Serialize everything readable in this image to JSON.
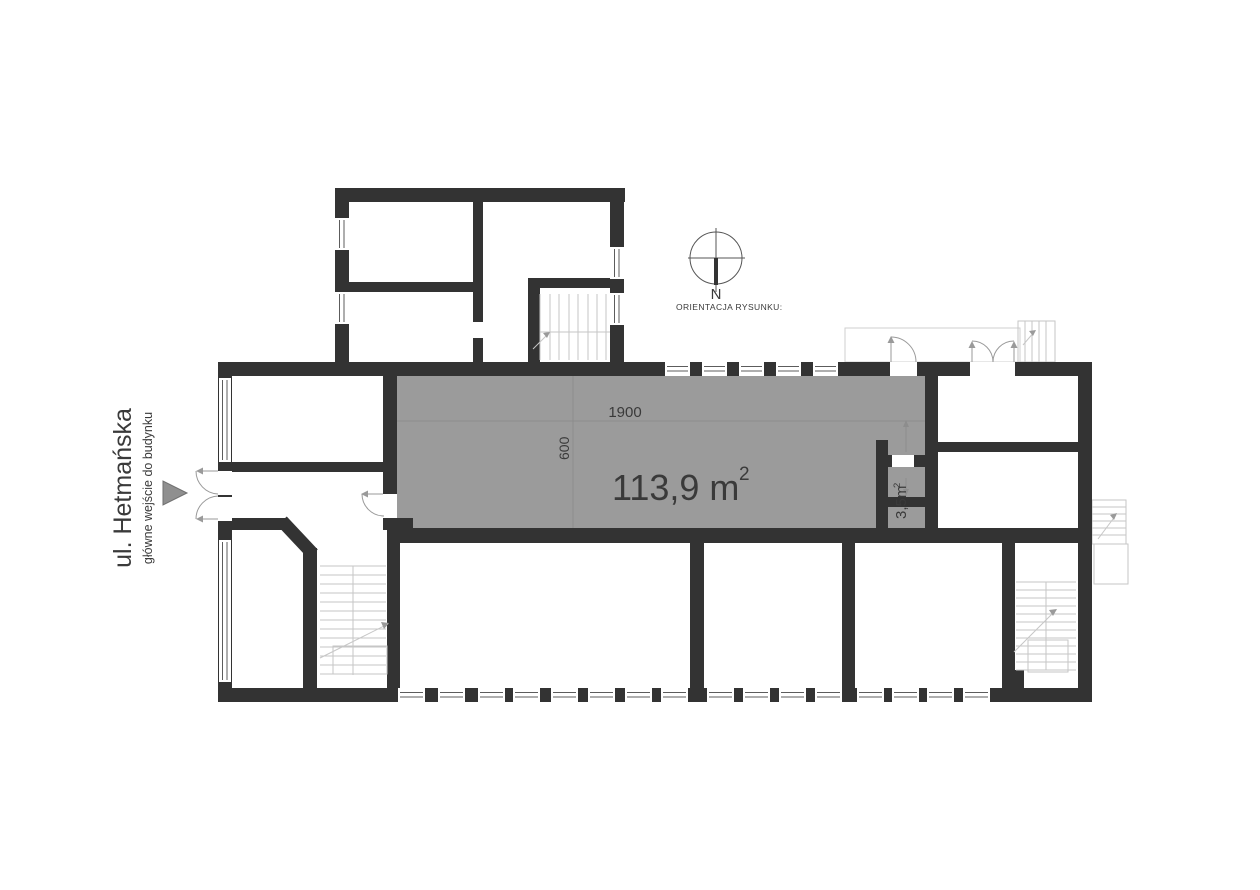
{
  "street": {
    "title": "ul. Hetmańska",
    "subtitle": "główne wejście do budynku"
  },
  "compass": {
    "north_label": "N",
    "caption": "ORIENTACJA RYSUNKU:"
  },
  "dimensions": {
    "width": "1900",
    "depth": "600"
  },
  "areas": {
    "main": {
      "value": "113,9 m",
      "sup": "2"
    },
    "small": {
      "value": "3,5m",
      "sup": "2"
    }
  },
  "colors": {
    "wall": "#333333",
    "highlight": "#9b9b9b",
    "dim_line": "#8d8d8d",
    "stair_line": "#c6c6c6",
    "door_arc": "#9a9a9a",
    "label": "#3a3a3a",
    "entrance_arrow": "#8f8f8f"
  }
}
